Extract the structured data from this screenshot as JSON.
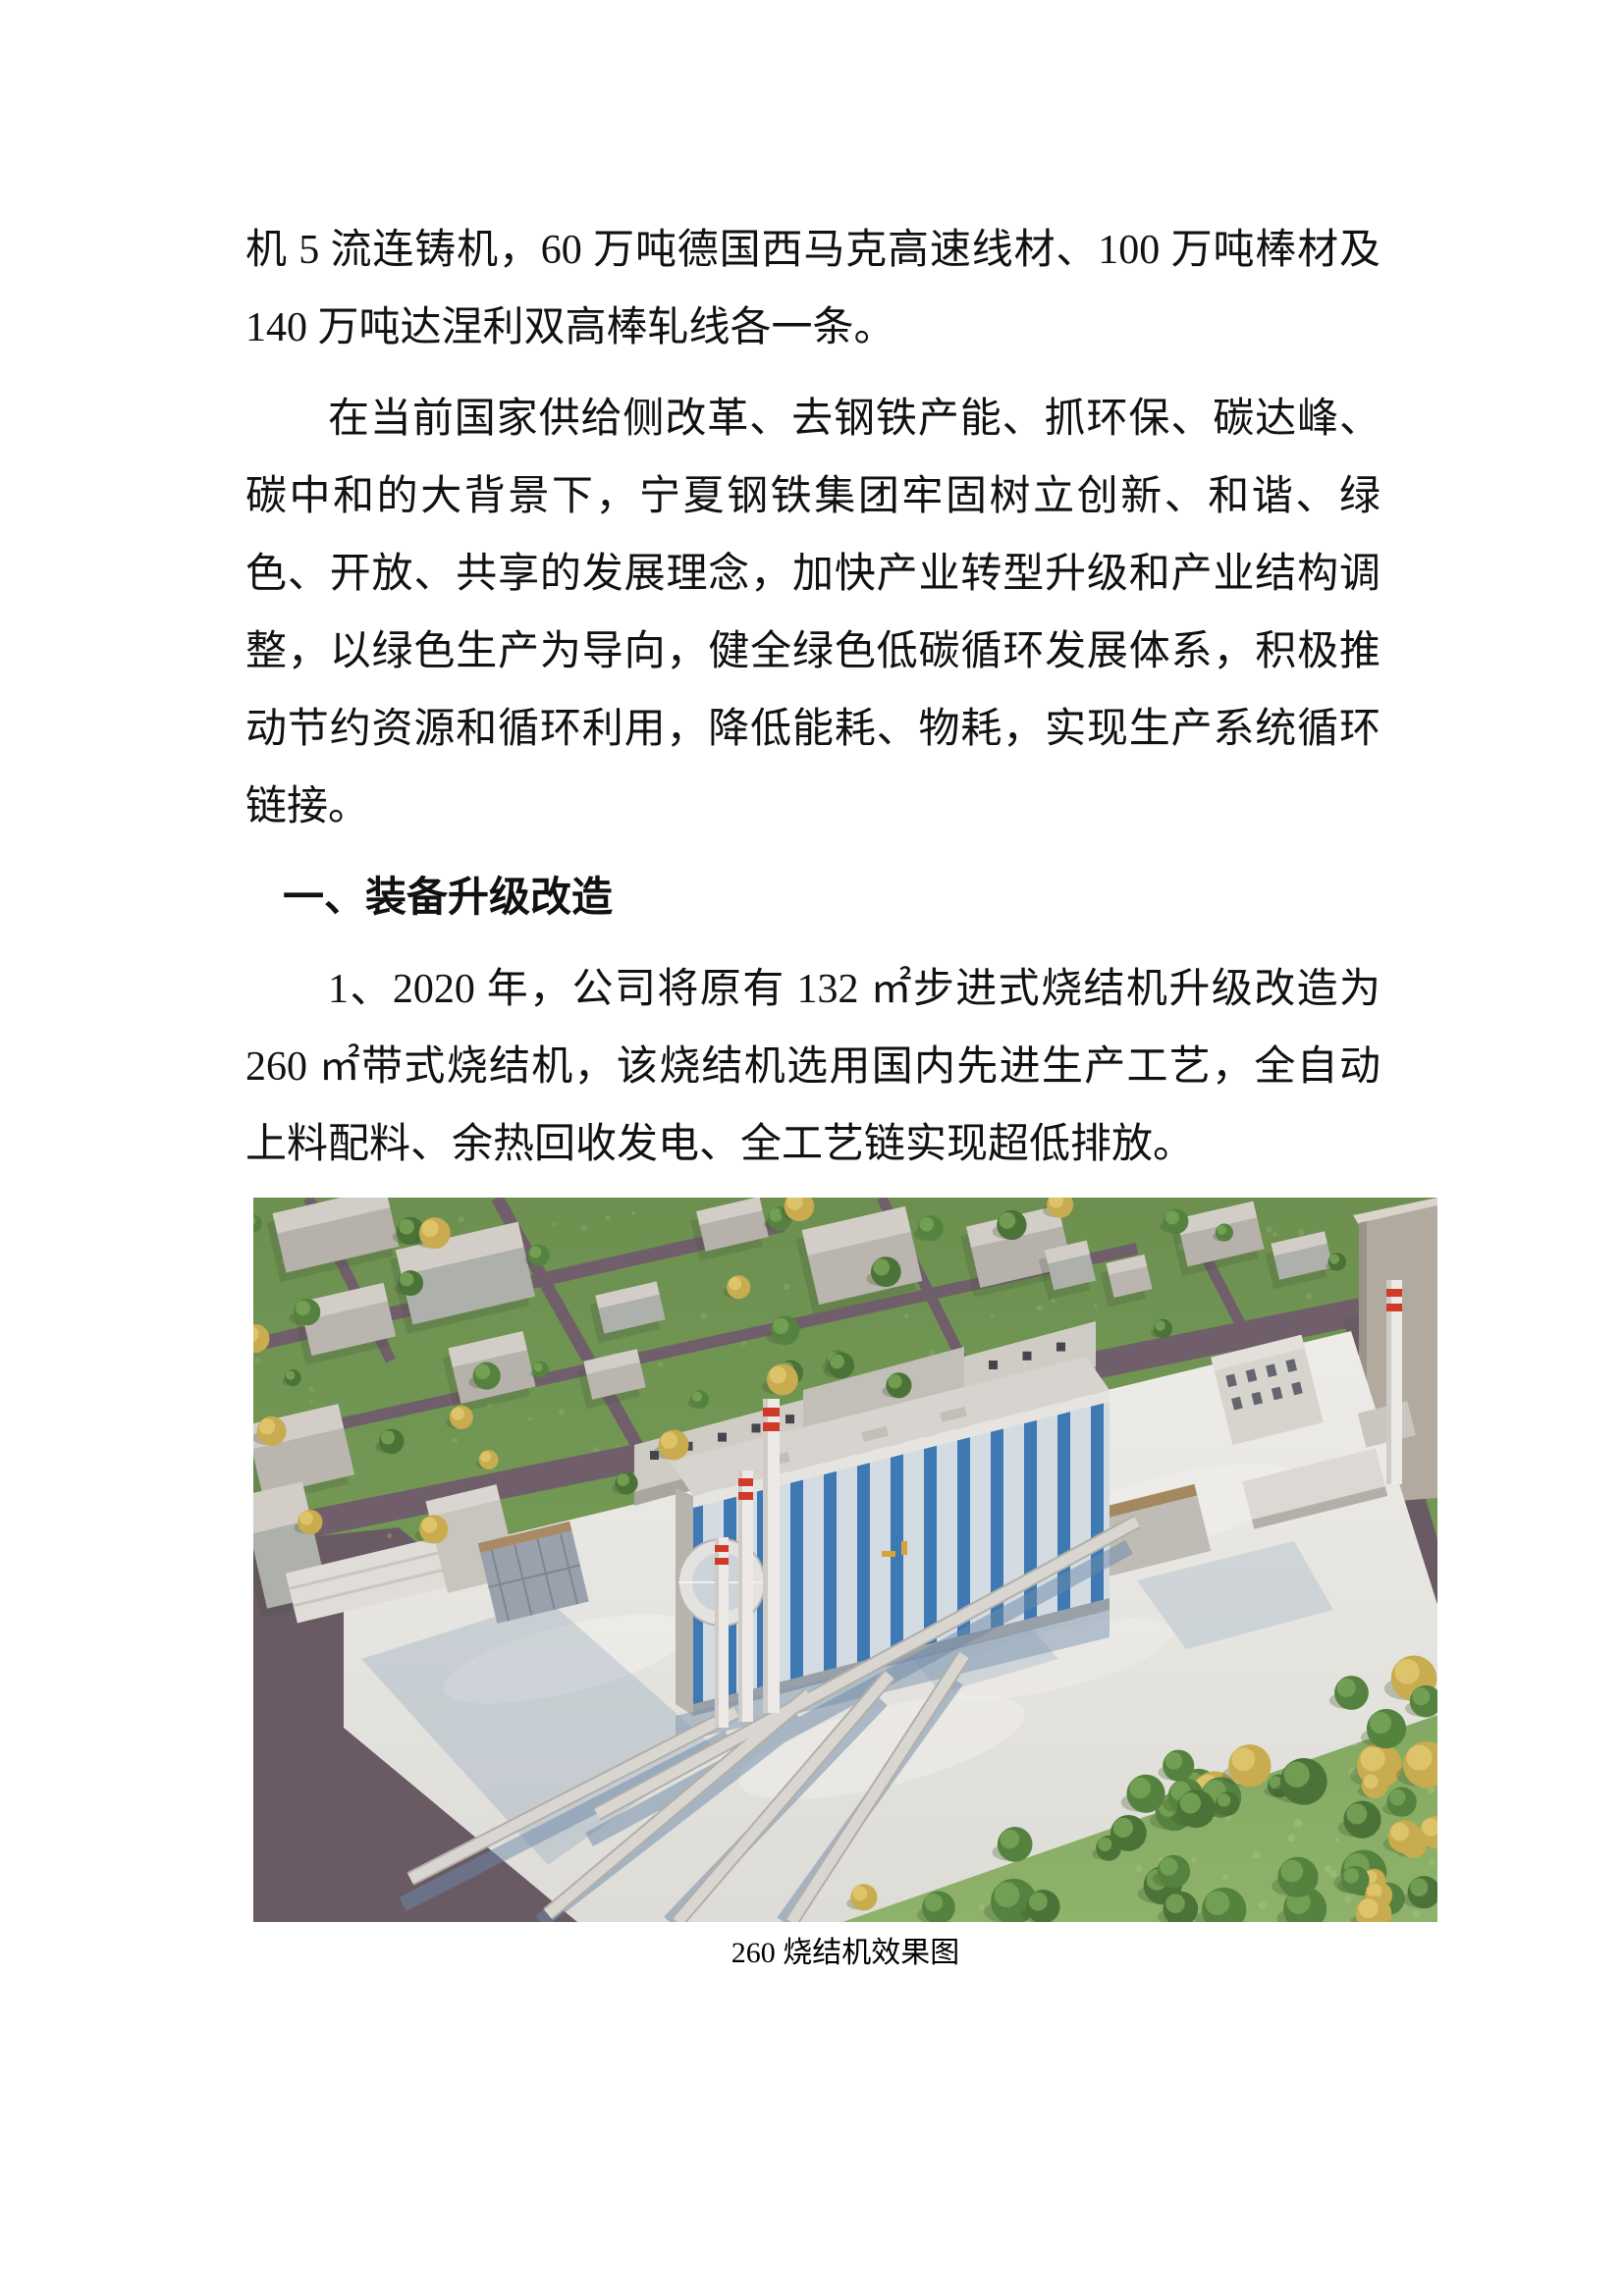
{
  "document": {
    "paragraph1": "机 5 流连铸机，60 万吨德国西马克高速线材、100 万吨棒材及 140 万吨达涅利双高棒轧线各一条。",
    "paragraph2": "在当前国家供给侧改革、去钢铁产能、抓环保、碳达峰、碳中和的大背景下，宁夏钢铁集团牢固树立创新、和谐、绿色、开放、共享的发展理念，加快产业转型升级和产业结构调整，以绿色生产为导向，健全绿色低碳循环发展体系，积极推动节约资源和循环利用，降低能耗、物耗，实现生产系统循环链接。",
    "heading1": "一、装备升级改造",
    "paragraph3": "1、2020 年，公司将原有 132 ㎡步进式烧结机升级改造为 260 ㎡带式烧结机，该烧结机选用国内先进生产工艺，全自动上料配料、余热回收发电、全工艺链实现超低排放。",
    "image_caption": "260 烧结机效果图"
  },
  "colors": {
    "text": "#111111",
    "grass_top_a": "#6d9050",
    "grass_top_b": "#7aa25a",
    "grass_field_a": "#7ea65e",
    "grass_field_b": "#8fb26b",
    "grass_speckle_top": "#8fae6d",
    "grass_speckle_field": "#a7c27f",
    "road": "#6d5c66",
    "concrete_a": "#edece8",
    "concrete_b": "#dedcd7",
    "building_front": "#b4afa8",
    "building_top": "#d2cec7",
    "stripe_blue": "#3e79b4",
    "chimney_red": "#d03a28",
    "shadow_blue": "#7b95b0",
    "tree_green": "#55823f",
    "tree_green2": "#4b7338",
    "tree_green_lite": "#78a558",
    "tree_yellow": "#c9ab50",
    "tree_yellow_lite": "#e0c86e"
  }
}
